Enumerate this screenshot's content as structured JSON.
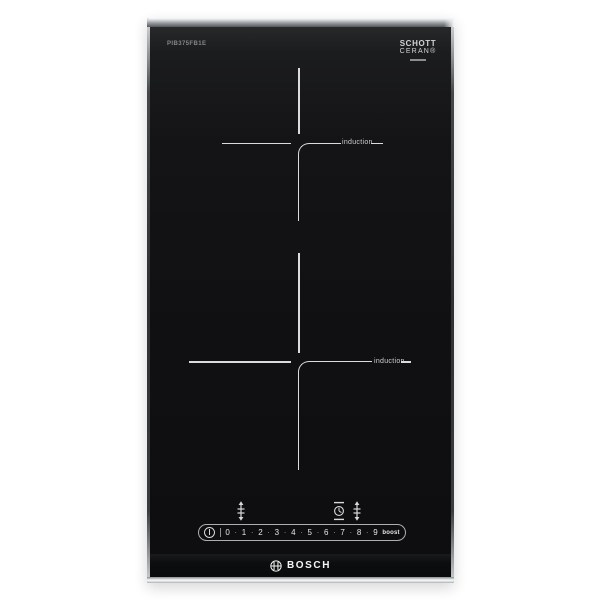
{
  "appliance": {
    "brand_logo": "BOSCH",
    "model_label": "PIB375FB1E",
    "glass_logo": {
      "line1": "SCHOTT",
      "line2": "CERAN®"
    }
  },
  "zones": [
    {
      "label": "induction"
    },
    {
      "label": "induction"
    }
  ],
  "controls": {
    "icons": {
      "power": "power-icon",
      "zone_select_left": "zone-select-arrows-icon",
      "timer": "timer-clock-icon",
      "zone_select_right": "zone-select-arrows-icon",
      "bosch_emblem": "bosch-armature-icon"
    },
    "slider": {
      "levels": [
        "0",
        "1",
        "2",
        "3",
        "4",
        "5",
        "6",
        "7",
        "8",
        "9"
      ],
      "dot": "·",
      "boost_label": "boost"
    }
  },
  "colors": {
    "background": "#ffffff",
    "glass": "#111113",
    "steel_frame": "#b9bec1",
    "zone_line": "#dcdcdc",
    "control_text": "#e6e6e6",
    "logo_text": "#f4f4f4"
  }
}
